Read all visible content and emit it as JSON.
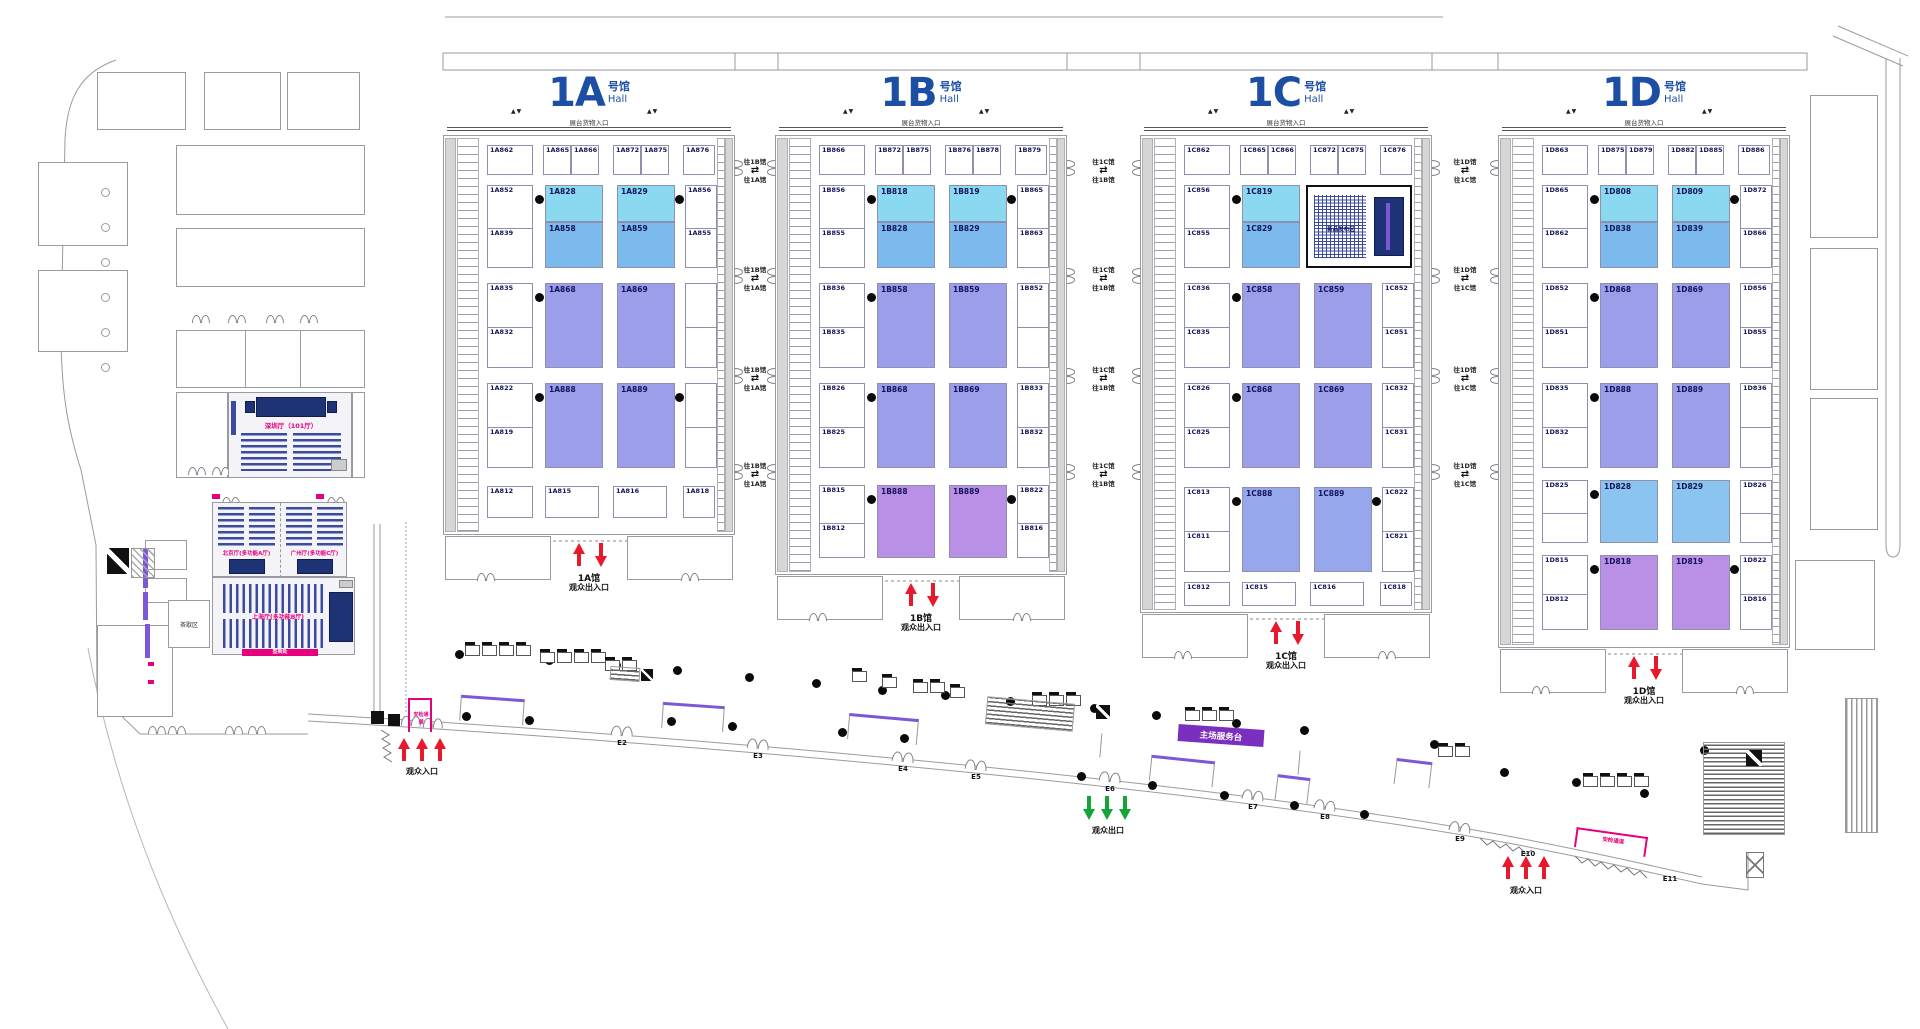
{
  "colors": {
    "cyan": "#8BD9F0",
    "blue": "#7CB9EC",
    "purple": "#9D9EE9",
    "violet": "#BA8FE6",
    "periwinkle": "#97A7EC",
    "lightblue": "#8AC4EF",
    "title_blue": "#1C4FA3",
    "red": "#E8192C",
    "green": "#13A538",
    "pink": "#E6007E",
    "stage_navy": "#1E3276",
    "banner_purple": "#7E57D8"
  },
  "shared": {
    "subtitle_cn": "号馆",
    "subtitle_en": "Hall",
    "dock_label": "展台货物入口",
    "exit_suffix": "观众出入口",
    "visitor_entrance": "观众入口",
    "visitor_exit": "观众出口"
  },
  "halls": [
    {
      "id": "1A",
      "name": "1A",
      "exit_line1": "1A馆",
      "top_booths": [
        "1A862",
        "1A865",
        "1A866",
        "1A872",
        "1A875",
        "1A876"
      ],
      "bottom_booths": [
        "1A812",
        "1A815",
        "1A816",
        "1A818"
      ],
      "rows": [
        {
          "type": "stacked",
          "color_top": "cyan",
          "color_bottom": "blue",
          "left": [
            "1A852",
            "1A839"
          ],
          "right": [
            "1A856",
            "1A855"
          ],
          "tops": [
            "1A828",
            "1A829"
          ],
          "bottoms": [
            "1A858",
            "1A859"
          ]
        },
        {
          "type": "big",
          "color": "purple",
          "left": [
            "1A835",
            "1A832"
          ],
          "right": [
            "",
            ""
          ],
          "bigs": [
            "1A868",
            "1A869"
          ]
        },
        {
          "type": "big",
          "color": "purple",
          "left": [
            "1A822",
            "1A819"
          ],
          "right": [
            "",
            ""
          ],
          "bigs": [
            "1A888",
            "1A889"
          ]
        }
      ]
    },
    {
      "id": "1B",
      "name": "1B",
      "exit_line1": "1B馆",
      "top_booths": [
        "1B866",
        "1B872",
        "1B875",
        "1B876",
        "1B878",
        "1B879"
      ],
      "bottom_booths": [],
      "rows": [
        {
          "type": "stacked",
          "color_top": "cyan",
          "color_bottom": "blue",
          "left": [
            "1B856",
            "1B855"
          ],
          "right": [
            "1B865",
            "1B863"
          ],
          "tops": [
            "1B818",
            "1B819"
          ],
          "bottoms": [
            "1B828",
            "1B829"
          ]
        },
        {
          "type": "big",
          "color": "purple",
          "left": [
            "1B836",
            "1B835"
          ],
          "right": [
            "1B852",
            ""
          ],
          "bigs": [
            "1B858",
            "1B859"
          ]
        },
        {
          "type": "big",
          "color": "purple",
          "left": [
            "1B826",
            "1B825"
          ],
          "right": [
            "1B833",
            "1B832"
          ],
          "bigs": [
            "1B868",
            "1B869"
          ]
        },
        {
          "type": "big",
          "color": "violet",
          "left": [
            "1B815",
            "1B812"
          ],
          "right": [
            "1B822",
            "1B816"
          ],
          "bigs": [
            "1B888",
            "1B889"
          ]
        }
      ]
    },
    {
      "id": "1C",
      "name": "1C",
      "exit_line1": "1C馆",
      "top_booths": [
        "1C862",
        "1C865",
        "1C866",
        "1C872",
        "1C875",
        "1C876"
      ],
      "bottom_booths": [
        "1C812",
        "1C815",
        "1C816",
        "1C818"
      ],
      "rows": [
        {
          "type": "stacked_feature",
          "color_top": "cyan",
          "color_bottom": "blue",
          "left": [
            "1C856",
            "1C855"
          ],
          "right": [
            "",
            ""
          ],
          "tops": [
            "1C819"
          ],
          "bottoms": [
            "1C829"
          ],
          "feature_label": "新品发布区"
        },
        {
          "type": "big",
          "color": "purple",
          "left": [
            "1C836",
            "1C835"
          ],
          "right": [
            "1C852",
            "1C851"
          ],
          "bigs": [
            "1C858",
            "1C859"
          ]
        },
        {
          "type": "big",
          "color": "purple",
          "left": [
            "1C826",
            "1C825"
          ],
          "right": [
            "1C832",
            "1C831"
          ],
          "bigs": [
            "1C868",
            "1C869"
          ]
        },
        {
          "type": "big",
          "color": "periwinkle",
          "left": [
            "1C813",
            "1C811"
          ],
          "right": [
            "1C822",
            "1C821"
          ],
          "bigs": [
            "1C888",
            "1C889"
          ]
        }
      ]
    },
    {
      "id": "1D",
      "name": "1D",
      "exit_line1": "1D馆",
      "top_booths": [
        "1D863",
        "1D875",
        "1D879",
        "1D882",
        "1D885",
        "1D886"
      ],
      "bottom_booths": [],
      "rows": [
        {
          "type": "stacked",
          "color_top": "cyan",
          "color_bottom": "blue",
          "left": [
            "1D865",
            "1D862"
          ],
          "right": [
            "1D872",
            "1D866"
          ],
          "tops": [
            "1D808",
            "1D809"
          ],
          "bottoms": [
            "1D838",
            "1D839"
          ]
        },
        {
          "type": "big",
          "color": "purple",
          "left": [
            "1D852",
            "1D851"
          ],
          "right": [
            "1D856",
            "1D855"
          ],
          "bigs": [
            "1D868",
            "1D869"
          ]
        },
        {
          "type": "big",
          "color": "purple",
          "left": [
            "1D835",
            "1D832"
          ],
          "right": [
            "1D836",
            ""
          ],
          "bigs": [
            "1D888",
            "1D889"
          ]
        },
        {
          "type": "big",
          "color": "lightblue",
          "left": [
            "1D825",
            ""
          ],
          "right": [
            "1D826",
            ""
          ],
          "bigs": [
            "1D828",
            "1D829"
          ]
        },
        {
          "type": "big",
          "color": "violet",
          "left": [
            "1D815",
            "1D812"
          ],
          "right": [
            "1D822",
            "1D816"
          ],
          "bigs": [
            "1D818",
            "1D819"
          ]
        }
      ]
    }
  ],
  "connectors": [
    {
      "right_label": "往1B馆",
      "left_label": "往1A馆"
    },
    {
      "right_label": "往1C馆",
      "left_label": "往1B馆"
    },
    {
      "right_label": "往1D馆",
      "left_label": "往1C馆"
    }
  ],
  "entrances": [
    {
      "id": "E2"
    },
    {
      "id": "E3"
    },
    {
      "id": "E4"
    },
    {
      "id": "E5"
    },
    {
      "id": "E6"
    },
    {
      "id": "E7"
    },
    {
      "id": "E8"
    },
    {
      "id": "E9"
    },
    {
      "id": "E10"
    },
    {
      "id": "E11"
    }
  ],
  "left_wing": {
    "hall_101": "深圳厅（101厅）",
    "hall_a": "北京厅(多功能A厅)",
    "hall_c": "广州厅(多功能C厅)",
    "hall_b": "上海厅(多功能B厅)",
    "tea": "茶歇区",
    "signin": "签到处"
  },
  "concourse": {
    "service_badge": "主场服务台",
    "security_label": "安检通道"
  }
}
